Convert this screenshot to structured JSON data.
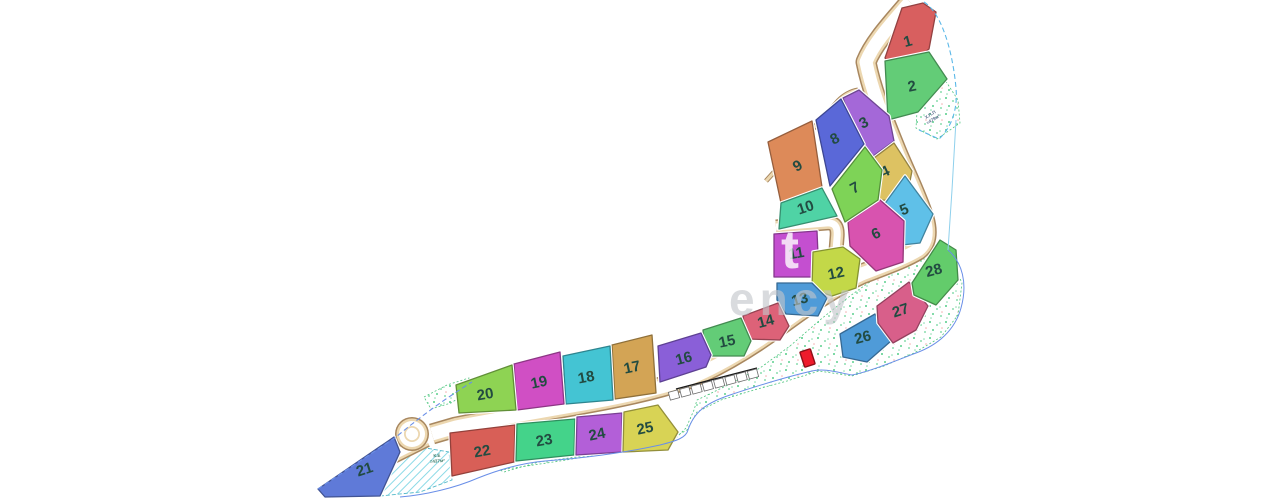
{
  "canvas": {
    "width": 1280,
    "height": 501
  },
  "map": {
    "background": "#ffffff",
    "palette": {
      "road_edge_dark": "#a8875f",
      "road_edge_tan": "#ecd7b0",
      "road_surface": "#ffffff",
      "dot_green": "#35c473",
      "dot_pink": "#e86a6a",
      "dotted_border": "#4ec57e",
      "hatch_cyan": "#7fd6e4",
      "hatch_border": "#53b9c9",
      "boundary_blue": "#6a8fe8",
      "boundary_cyan": "#8fd0ec",
      "label_color": "#224b41",
      "marker_fill": "#ee1c2c",
      "marker_stroke": "#8e1018",
      "parking_line": "#1a1a1a"
    },
    "dotted_areas": [
      {
        "name": "green-area-top-right",
        "points": "917,112 945,80 958,100 960,123 937,139 916,128"
      },
      {
        "name": "green-area-main",
        "points": "500,470 560,461 620,451 672,442 686,428 694,410 697,400 730,384 760,368 790,346 820,320 850,296 878,276 898,262 914,248 930,243 949,255 962,283 958,315 941,337 914,353 884,366 852,376 819,371 787,381 754,390 721,400 697,412 687,430 667,441 629,449 584,456 539,462 504,472"
      },
      {
        "name": "green-area-roundabout",
        "points": "424,397 447,385 469,378 471,390 451,403 431,409"
      }
    ],
    "hatched_areas": [
      {
        "name": "hatched-slope-area",
        "points": "393,440 420,447 449,452 452,480 420,492 380,496"
      }
    ],
    "roads": [
      {
        "name": "main-road",
        "d": "M 910,2 C 893,22 874,42 866,62 C 872,92 884,120 896,150 C 905,172 917,196 924,218 C 928,232 927,243 918,250 C 905,258 888,264 862,274 C 838,285 812,302 786,321 C 758,342 724,364 688,379 C 652,391 612,399 572,406 C 532,413 492,420 456,427 L 432,434",
        "w": 21
      },
      {
        "name": "roundabout-exit-road",
        "d": "M 426,439 C 410,447 392,456 372,466",
        "w": 17
      },
      {
        "name": "access-lane",
        "d": "M 776,227 L 826,223 C 836,222 838,228 837,238 L 833,288",
        "w": 15
      },
      {
        "name": "footpath",
        "d": "M 815,120 L 839,206",
        "w": 6,
        "whiteOnly": true
      }
    ],
    "trim_edges": [
      {
        "name": "cluster-top-edge-trim",
        "d": "M 766,181 L 838,101 Q 847,92 858,90"
      }
    ],
    "roundabout": {
      "cx": 412,
      "cy": 434,
      "r_outer": 17,
      "r_ring": 15.5,
      "r_road": 13,
      "r_island_outer": 8,
      "r_island_inner": 6.2
    },
    "parking": {
      "count": 8,
      "line": {
        "x1": 674,
        "y1": 394,
        "x2": 753,
        "y2": 373
      },
      "topline": {
        "x1": 676,
        "y1": 389,
        "x2": 757,
        "y2": 368
      },
      "rect_w": 9.5,
      "rect_h": 8
    },
    "boundary_segments": [
      {
        "name": "boundary-top-right",
        "d": "M 924,2 C 943,14 953,55 956,88 C 958,110 951,128 939,139 L 919,130",
        "color": "#5bb8e8",
        "dash": "5,3",
        "w": 1.1
      },
      {
        "name": "boundary-right",
        "d": "M 956,120 L 952,190 L 948,250",
        "color": "#8fd0ec",
        "dash": "",
        "w": 1
      },
      {
        "name": "boundary-main",
        "d": "M 948,250 C 962,262 968,283 961,308 C 955,330 938,345 916,353 C 893,362 868,372 852,375 C 836,372 824,368 812,371 C 790,376 760,385 730,395 C 706,403 694,412 688,430 C 686,438 676,441 660,445 C 628,452 585,458 545,461 C 522,463 498,470 478,478 C 455,488 425,495 400,497",
        "color": "#6a8fe8",
        "dash": "",
        "w": 1
      },
      {
        "name": "boundary-left-dashed",
        "d": "M 318,489 L 396,437 C 420,417 446,398 472,382",
        "color": "#6a8fe8",
        "dash": "5,3",
        "w": 1.1
      }
    ],
    "lots": [
      {
        "n": "1",
        "color": "#d85f5f",
        "points": "885,58 902,8 923,3 936,12 929,49 897,73",
        "label": {
          "x": 909,
          "y": 46,
          "r": -15
        }
      },
      {
        "n": "2",
        "color": "#63cc77",
        "points": "885,61 929,52 947,79 918,112 888,120",
        "label": {
          "x": 913,
          "y": 91,
          "r": -12
        }
      },
      {
        "n": "3",
        "color": "#a468d8",
        "points": "843,98 859,90 889,116 894,141 865,162",
        "label": {
          "x": 866,
          "y": 127,
          "r": -28
        }
      },
      {
        "n": "4",
        "color": "#ddc262",
        "points": "866,164 894,143 912,171 906,201 879,200",
        "label": {
          "x": 887,
          "y": 176,
          "r": -25
        }
      },
      {
        "n": "5",
        "color": "#5fc0e8",
        "points": "905,176 933,214 920,243 893,246 881,209",
        "label": {
          "x": 906,
          "y": 214,
          "r": -22
        }
      },
      {
        "n": "6",
        "color": "#d853af",
        "points": "848,222 880,200 904,221 903,262 876,271 850,246",
        "label": {
          "x": 878,
          "y": 238,
          "r": -25
        }
      },
      {
        "n": "7",
        "color": "#7ed357",
        "points": "832,189 865,147 882,170 878,200 845,222",
        "label": {
          "x": 857,
          "y": 192,
          "r": -28
        }
      },
      {
        "n": "8",
        "color": "#5a68d8",
        "points": "816,120 841,99 864,144 830,186",
        "label": {
          "x": 837,
          "y": 143,
          "r": -28
        }
      },
      {
        "n": "9",
        "color": "#dd8a59",
        "points": "768,142 812,121 822,187 781,203",
        "label": {
          "x": 800,
          "y": 170,
          "r": -30
        }
      },
      {
        "n": "10",
        "color": "#4fd3a5",
        "points": "781,203 822,188 837,216 779,229",
        "label": {
          "x": 807,
          "y": 212,
          "r": -18
        }
      },
      {
        "n": "11",
        "color": "#c44fd0",
        "points": "774,234 817,231 819,277 774,277",
        "label": {
          "x": 797,
          "y": 258,
          "r": -10
        }
      },
      {
        "n": "12",
        "color": "#c3d848",
        "points": "813,252 843,247 860,259 856,288 832,296 812,289",
        "label": {
          "x": 837,
          "y": 278,
          "r": -12
        }
      },
      {
        "n": "13",
        "color": "#4f9bd8",
        "points": "777,283 812,283 827,298 818,316 786,314 777,300",
        "label": {
          "x": 801,
          "y": 304,
          "r": -15
        }
      },
      {
        "n": "14",
        "color": "#dd6278",
        "points": "743,316 778,303 789,326 780,340 747,339",
        "label": {
          "x": 767,
          "y": 326,
          "r": -15
        }
      },
      {
        "n": "15",
        "color": "#63cc77",
        "points": "703,330 741,318 751,341 744,356 705,356",
        "label": {
          "x": 728,
          "y": 346,
          "r": -12
        }
      },
      {
        "n": "16",
        "color": "#8a5fd8",
        "points": "658,346 701,333 711,355 706,367 660,382",
        "label": {
          "x": 685,
          "y": 363,
          "r": -15
        }
      },
      {
        "n": "17",
        "color": "#d3a455",
        "points": "612,345 652,335 656,393 615,399",
        "label": {
          "x": 633,
          "y": 372,
          "r": -12
        }
      },
      {
        "n": "18",
        "color": "#44c4d3",
        "points": "563,356 610,346 613,400 566,404",
        "label": {
          "x": 587,
          "y": 382,
          "r": -10
        }
      },
      {
        "n": "19",
        "color": "#d04fc4",
        "points": "514,364 560,352 564,404 517,410",
        "label": {
          "x": 540,
          "y": 387,
          "r": -12
        }
      },
      {
        "n": "20",
        "color": "#8ed353",
        "points": "456,385 512,365 516,410 459,413",
        "label": {
          "x": 486,
          "y": 399,
          "r": -10
        }
      },
      {
        "n": "21",
        "color": "#5f7ad8",
        "points": "318,489 394,437 400,452 380,496 325,497",
        "label": {
          "x": 366,
          "y": 474,
          "r": -18
        }
      },
      {
        "n": "22",
        "color": "#d85f57",
        "points": "450,433 515,425 514,462 452,476",
        "label": {
          "x": 483,
          "y": 456,
          "r": -10
        }
      },
      {
        "n": "23",
        "color": "#44d38a",
        "points": "517,424 575,419 574,455 516,461",
        "label": {
          "x": 545,
          "y": 445,
          "r": -10
        }
      },
      {
        "n": "24",
        "color": "#b35fd8",
        "points": "577,417 622,413 622,452 576,455",
        "label": {
          "x": 598,
          "y": 439,
          "r": -12
        }
      },
      {
        "n": "25",
        "color": "#d8d355",
        "points": "624,412 658,405 678,432 668,450 623,452",
        "label": {
          "x": 646,
          "y": 433,
          "r": -12
        }
      },
      {
        "n": "26",
        "color": "#4f9bd8",
        "points": "840,334 875,314 891,341 867,362 843,357",
        "label": {
          "x": 864,
          "y": 342,
          "r": -15
        }
      },
      {
        "n": "27",
        "color": "#d85f8a",
        "points": "877,306 909,282 928,306 916,330 893,343 878,323",
        "label": {
          "x": 902,
          "y": 315,
          "r": -18
        }
      },
      {
        "n": "28",
        "color": "#63cc6b",
        "points": "912,283 940,240 956,250 958,280 936,305 914,295",
        "label": {
          "x": 935,
          "y": 275,
          "r": -15
        }
      }
    ],
    "marker": {
      "x": 802,
      "y": 350,
      "w": 11,
      "h": 16,
      "rotate": -18
    },
    "annotations": [
      {
        "name": "area-note-top",
        "lines": [
          "Х.П.П",
          "=479м²"
        ],
        "x": 931,
        "y": 116,
        "r": -32,
        "size": 4.5,
        "color": "#5a6b8c"
      },
      {
        "name": "area-note-left",
        "lines": [
          "К.Е",
          "=437м²"
        ],
        "x": 437,
        "y": 457,
        "r": -4,
        "size": 4.5,
        "color": "#3f7d6b"
      }
    ],
    "watermarks": [
      {
        "text": "t",
        "x": 781,
        "y": 268,
        "size": 54,
        "color": "#ffffff",
        "opacity": 0.8,
        "spacing": 0
      },
      {
        "text": "ency",
        "x": 729,
        "y": 315,
        "size": 46,
        "color": "#c3c6cb",
        "opacity": 0.62,
        "spacing": 5
      }
    ]
  }
}
